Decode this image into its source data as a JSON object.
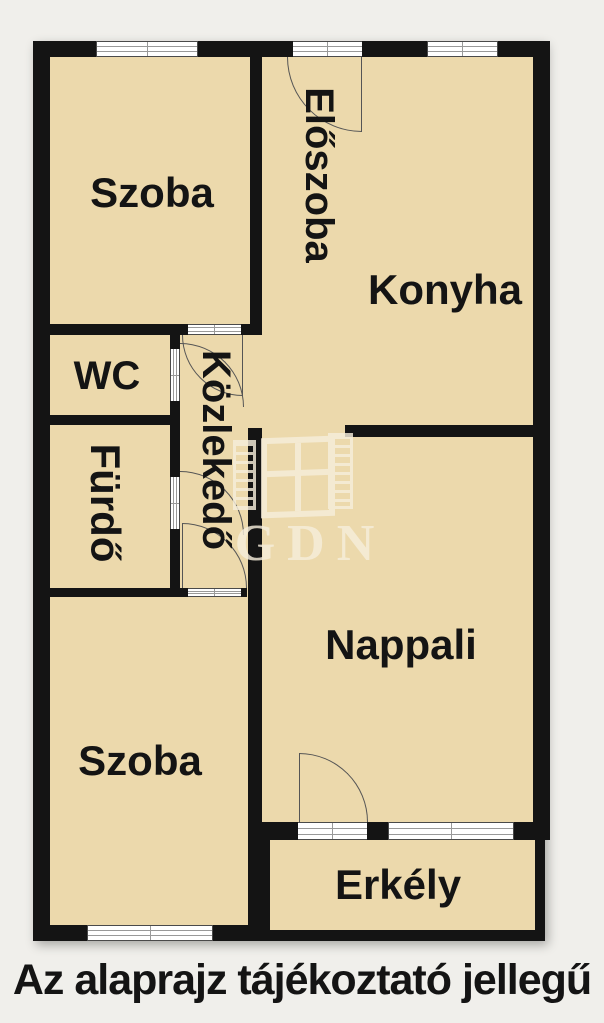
{
  "rooms": [
    {
      "id": "szoba-1",
      "label": "Szoba"
    },
    {
      "id": "eloszoba",
      "label": "Előszoba"
    },
    {
      "id": "konyha",
      "label": "Konyha"
    },
    {
      "id": "wc",
      "label": "WC"
    },
    {
      "id": "furdo",
      "label": "Fürdő"
    },
    {
      "id": "kozlekedo",
      "label": "Közlekedő"
    },
    {
      "id": "nappali",
      "label": "Nappali"
    },
    {
      "id": "szoba-2",
      "label": "Szoba"
    },
    {
      "id": "erkely",
      "label": "Erkély"
    }
  ],
  "watermark_text": "GDN",
  "caption": "Az alaprajz tájékoztató jellegű",
  "colors": {
    "floor": "#ecd9ac",
    "wall": "#141414",
    "bg": "#f0efeb",
    "watermark": "#f6eedb",
    "frame": "#ffffff",
    "arc": "#555555",
    "text": "#141414"
  }
}
